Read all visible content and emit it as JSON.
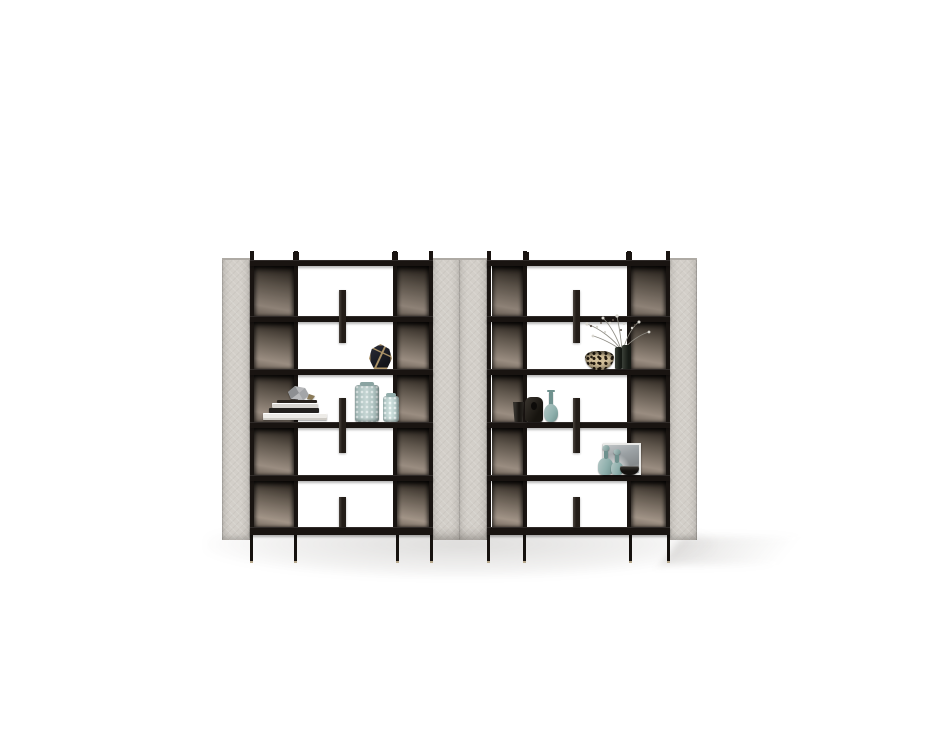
{
  "scene": {
    "type": "furniture-product-render",
    "subject": "two modular etagere bookcases with upholstered side panels, smoked bronze back panels, black metal frame and decorative objects",
    "background_color": "#ffffff",
    "units": [
      {
        "id": "left-bookshelf",
        "shelves": 6,
        "rows": 5,
        "columns": [
          "smoked-back",
          "open",
          "smoked-back"
        ],
        "divider_tabs": 3,
        "legs": 4,
        "decor": [
          "faceted-geometric-vase",
          "book-stack",
          "crystal-figurine",
          "knurled-glass-vase-tall",
          "knurled-glass-vase-short"
        ]
      },
      {
        "id": "right-bookshelf",
        "shelves": 6,
        "rows": 5,
        "columns": [
          "smoked-back",
          "open",
          "smoked-back"
        ],
        "divider_tabs": 3,
        "legs": 4,
        "decor": [
          "mosaic-leopard-bowl",
          "bud-vases-with-dried-flowers",
          "dark-faceted-cup",
          "dark-vessel",
          "teal-genie-vase",
          "teal-stoppered-bottle-tall",
          "teal-stoppered-bottle-short",
          "framed-art-print",
          "dark-bowl"
        ]
      }
    ]
  },
  "colors": {
    "background": "#ffffff",
    "panel": "#d3cfc9",
    "panel_edge": "#aeaaa4",
    "panel_shade": "#c2beb8",
    "frame": "#191411",
    "smoke_dark": "#211b16",
    "smoke_mid": "#5f564c",
    "smoke_light": "#9a8d81",
    "tab": "#231d18",
    "leg": "#15110e",
    "foot": "#b5a78c",
    "teal_light": "#b6c9c7",
    "teal": "#8fb0ad",
    "teal_dark": "#6f918e",
    "gold": "#ad9468",
    "navy_facet": "#262833",
    "book_white": "#edebe7",
    "book_dark": "#24211e",
    "book_gray": "#d8d5d0",
    "silver": "#b9babc",
    "leopard_base": "#d3c09a",
    "leopard_spot": "#241b10",
    "dark_object": "#262220",
    "art_gray": "#9aa0a3",
    "frame_white": "#e9e9e7",
    "sprig": "#8e8c84",
    "bloom": "#d9d7d0",
    "shadow": "rgba(90,84,78,0.20)"
  }
}
